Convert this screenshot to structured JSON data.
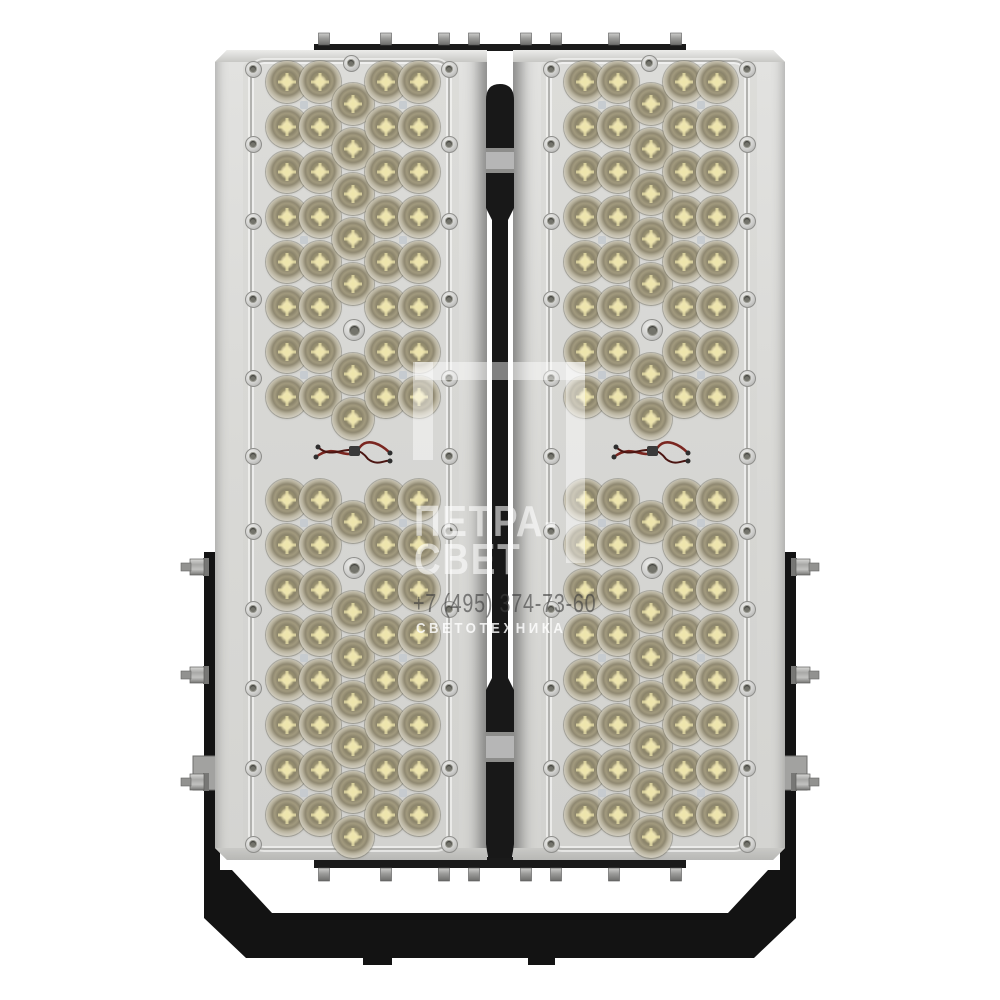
{
  "image": {
    "type": "product-photo",
    "subject": "Two-module LED floodlight, front view, on white background"
  },
  "watermark": {
    "logo_symbol": "open-frame-bracket",
    "brand_line1": "ПЕТРА-",
    "brand_line2": "СВЕТ",
    "phone": "+7 (495) 374-73-60",
    "tagline": "СВЕТОТЕХНИКА"
  },
  "product": {
    "panels": 2,
    "modules_per_panel": 2,
    "lens_columns_per_module": 5,
    "lens_rows_per_column": 8,
    "total_lenses": 160
  },
  "colors": {
    "background": "#ffffff",
    "housing_gray": "#d9d9d6",
    "lens_amber": "#cfc49a",
    "lens_ring_khaki": "#8f8871",
    "hardware_black": "#141414",
    "spine_band_gray": "#b6b6b6",
    "bolt_gray": "#9a9a9a",
    "watermark_white": "rgba(255,255,255,0.55)",
    "watermark_phone_gray": "rgba(62,62,62,0.62)"
  }
}
